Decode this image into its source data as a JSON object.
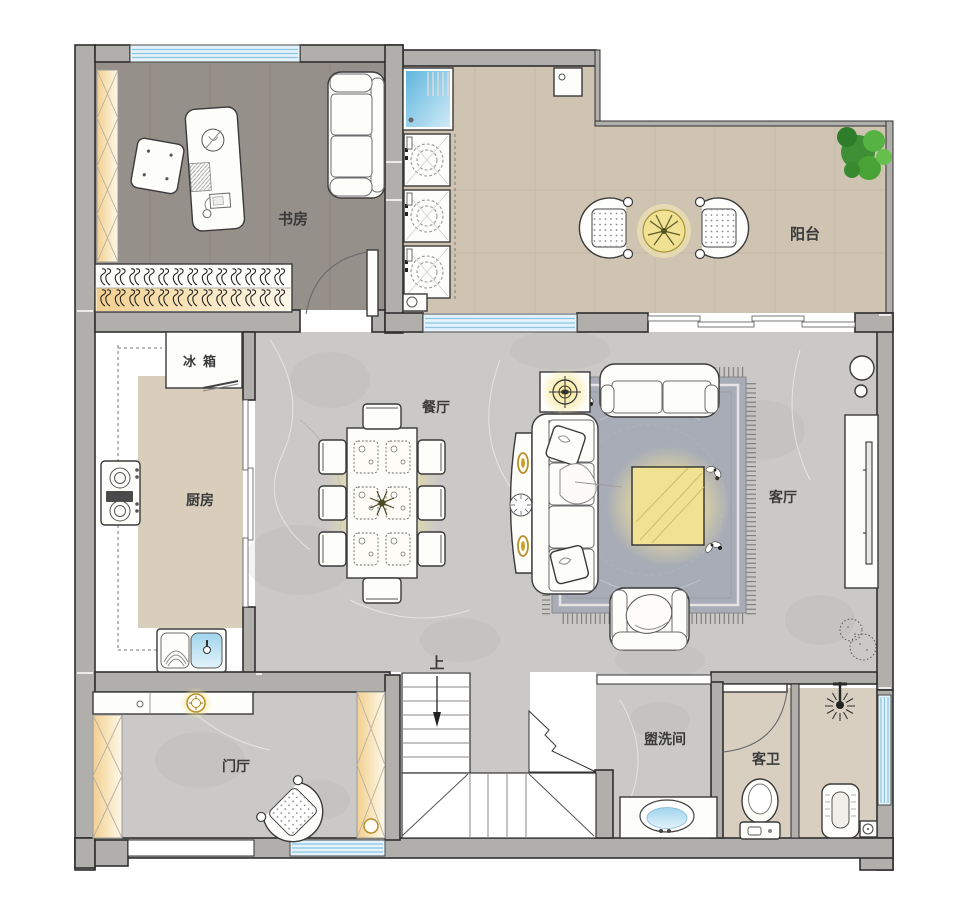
{
  "labels": {
    "study": "书房",
    "balcony": "阳台",
    "fridge": "冰箱",
    "kitchen": "厨房",
    "dining": "餐厅",
    "living": "客厅",
    "foyer": "门厅",
    "stairs_up": "上",
    "washroom": "盥洗间",
    "guest_bath": "客卫"
  },
  "colors": {
    "wall": "#b0afac",
    "wallStroke": "#2f2f2f",
    "windowFill": "#e3f2fb",
    "windowLine": "#8ec6e0",
    "floorMarble": "#cac9c7",
    "floorStudy": "#96908a",
    "floorBalcony": "#cfc3b1",
    "floorKitchen": "#d9cdbb",
    "floorBath": "#d8cfc1",
    "accentYellow": "#f1e193",
    "glowYellow": "#f6e387",
    "amber": "#f5d898",
    "gold": "#b8912a",
    "rug": "#a8acb6",
    "plantGreen": "#46993b",
    "labelColor": "#3a3a3a"
  }
}
